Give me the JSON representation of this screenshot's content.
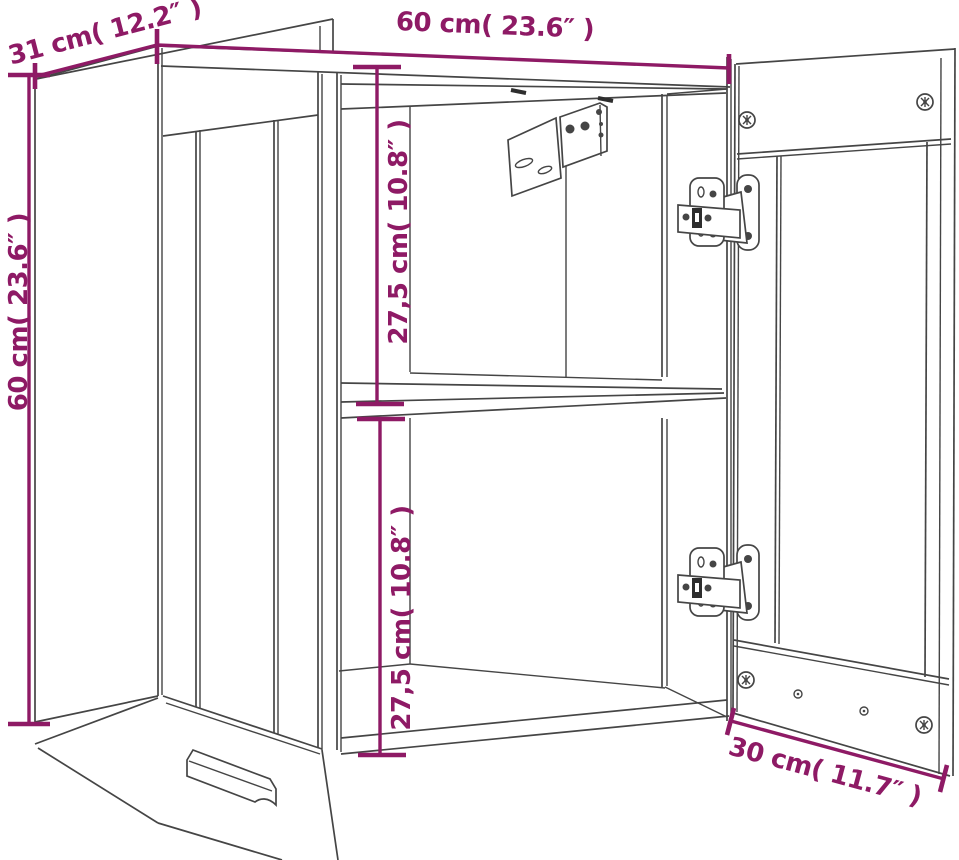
{
  "diagram": {
    "colors": {
      "dimension": "#8e1a65",
      "line": "#454545",
      "background": "#ffffff"
    },
    "dimensions": {
      "depth_top_left": {
        "label": "31 cm( 12.2″ )",
        "value_cm": "31",
        "value_in": "12.2"
      },
      "width_top": {
        "label": "60 cm( 23.6″ )",
        "value_cm": "60",
        "value_in": "23.6"
      },
      "height_left": {
        "label": "60 cm( 23.6″ )",
        "value_cm": "60",
        "value_in": "23.6"
      },
      "upper_compartment": {
        "label": "27,5 cm( 10.8″ )",
        "value_cm": "27,5",
        "value_in": "10.8"
      },
      "lower_compartment": {
        "label": "27,5 cm( 10.8″ )",
        "value_cm": "27,5",
        "value_in": "10.8"
      },
      "door_width_bottom": {
        "label": "30 cm( 11.7″ )",
        "value_cm": "30",
        "value_in": "11.7"
      }
    }
  }
}
